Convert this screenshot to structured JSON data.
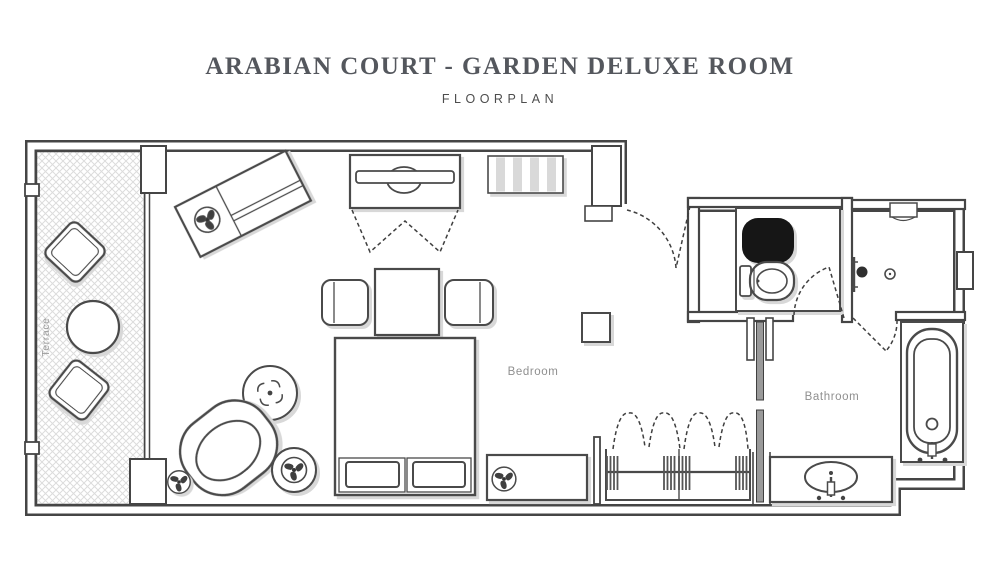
{
  "title": "ARABIAN COURT - GARDEN DELUXE ROOM",
  "subtitle": "FLOORPLAN",
  "rooms": {
    "terrace": "Terrace",
    "bedroom": "Bedroom",
    "bathroom": "Bathroom"
  },
  "colors": {
    "wall": "#454545",
    "furniture_stroke": "#4a4a4a",
    "shadow": "#d8d8d8",
    "hatch": "#d9d9d9",
    "stripe": "#d9d9d9",
    "label": "#8f8f8f",
    "title_text": "#54575d",
    "fixture_black": "#161616",
    "door_panel": "#9a9a9a"
  },
  "furniture": {
    "terrace_items": [
      "lounge-chair",
      "round-table",
      "lounge-chair"
    ],
    "bedroom_items": [
      "chaise-lounge",
      "tv-cabinet",
      "striped-bench",
      "dining-chair",
      "dining-table",
      "dining-chair",
      "king-bed",
      "round-coffee-table",
      "armchair",
      "side-table",
      "plant",
      "console-table",
      "square-side-table",
      "wardrobe"
    ],
    "bathroom_items": [
      "black-counter-basin",
      "toilet",
      "shower-head",
      "shower-drain",
      "wall-niche",
      "bathtub",
      "vanity-sink",
      "sliding-door"
    ]
  }
}
